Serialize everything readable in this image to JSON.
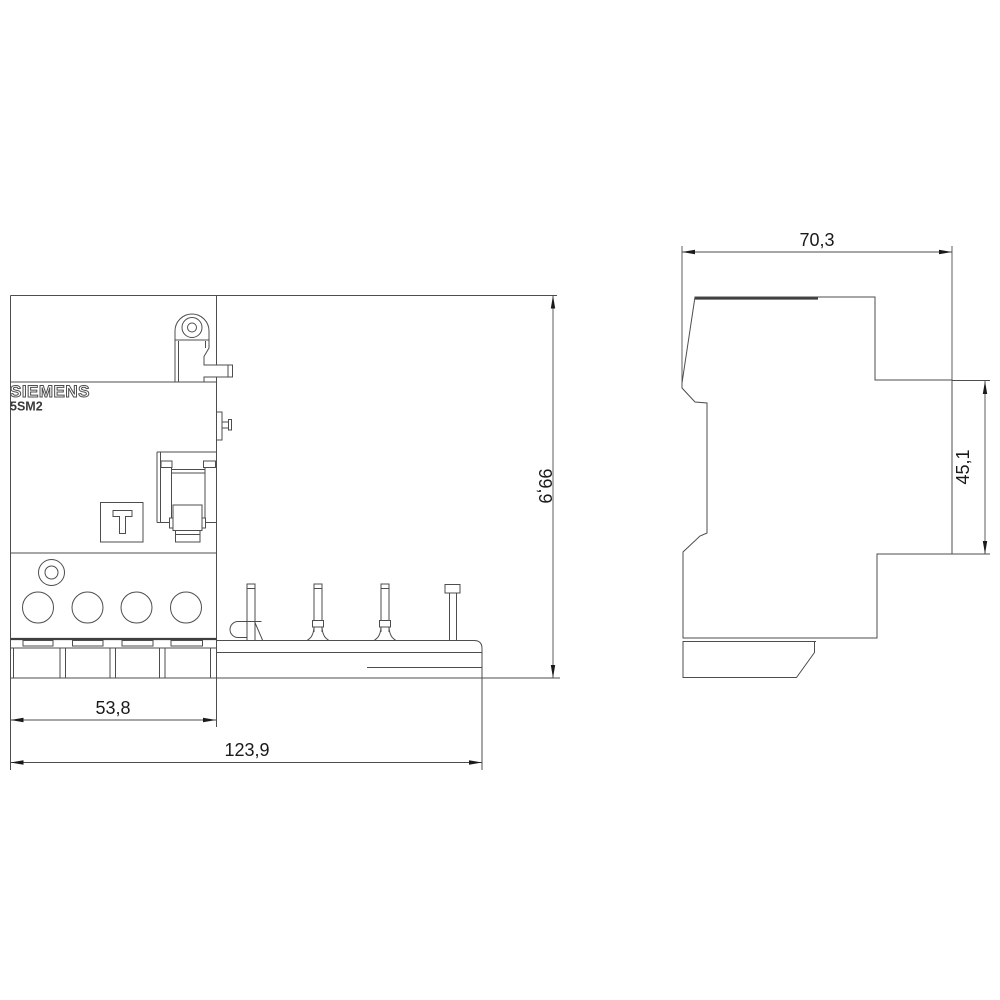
{
  "meta": {
    "background_color": "#ffffff",
    "line_color": "#4d4d4d",
    "text_color": "#1a1a1a",
    "drawing_type": "dimensional outline drawing, front and side view"
  },
  "device": {
    "brand": "SIEMENS",
    "model": "5SM2",
    "test_button_label": "T"
  },
  "dimensions": {
    "side_total_width_mm": "70,3",
    "side_body_height_mm": "45,1",
    "front_total_height_mm": "99,9",
    "front_module_width_mm": "53,8",
    "front_total_width_mm": "123,9"
  }
}
